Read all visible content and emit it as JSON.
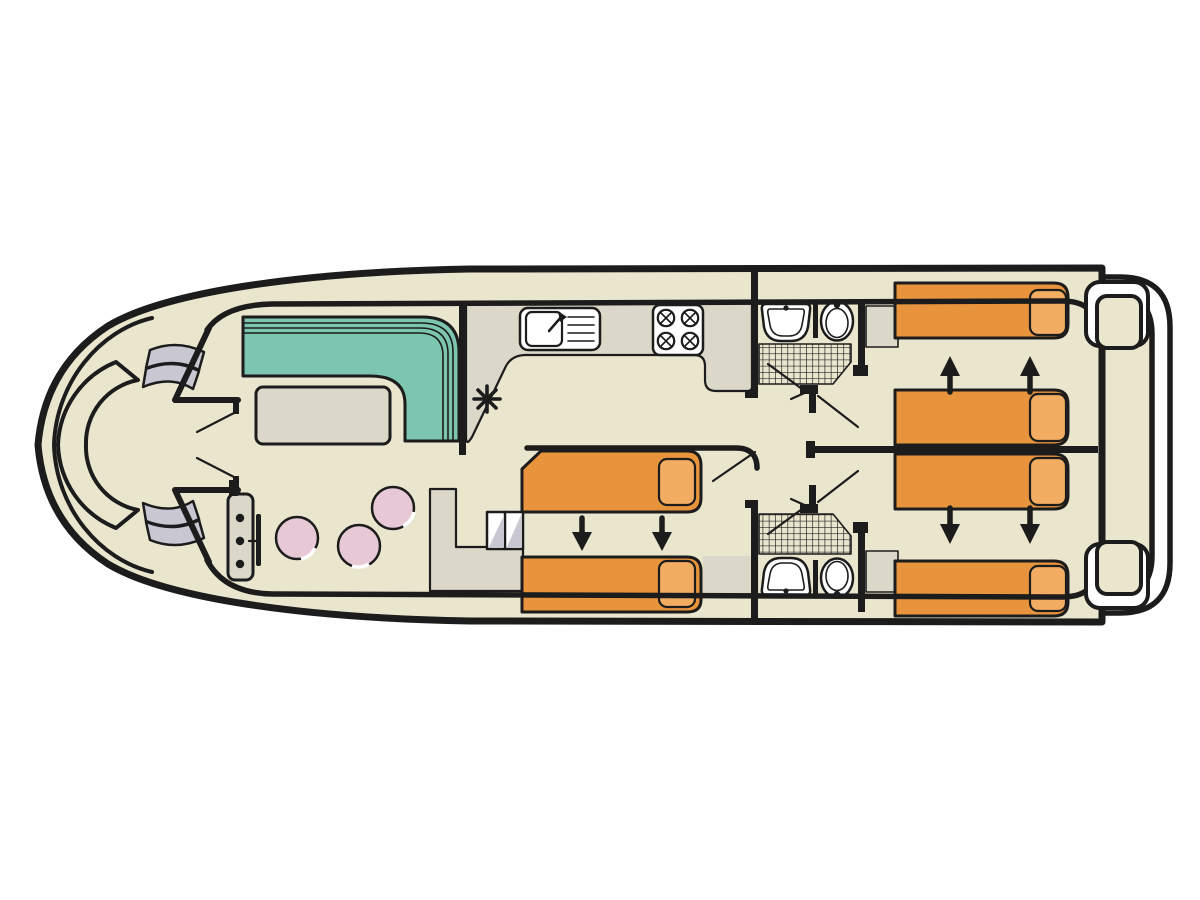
{
  "diagram": {
    "type": "boat-floor-plan",
    "orientation": "bow-left-stern-right"
  },
  "colors": {
    "background": "#ffffff",
    "outline": "#1c1c1c",
    "hull_cream": "#eae6ce",
    "floor_gray": "#dbd8c9",
    "steps_gray": "#c9c8d2",
    "sofa_teal": "#7cc5ae",
    "bed_orange": "#e8943c",
    "pillow_orange": "#f2ad62",
    "stool_pink": "#e7c9d6",
    "fixture_white": "#ffffff"
  },
  "features": {
    "bow_bench_seats": 1,
    "bow_side_step_flights": 2,
    "helm_console_instruments": 3,
    "helm_stools": 3,
    "saloon_sofa_shape": "L",
    "saloon_tables": 1,
    "galley_sink": 1,
    "galley_drainer_lines": 4,
    "galley_hob_burners": 4,
    "cabins": [
      {
        "position": "midship",
        "single_beds": 2,
        "slide_arrows": 2
      },
      {
        "position": "aft-top",
        "single_beds": 2,
        "slide_arrows": 2
      },
      {
        "position": "aft-bottom",
        "single_beds": 2,
        "slide_arrows": 2
      }
    ],
    "bathrooms": [
      {
        "position": "top",
        "basin": 1,
        "toilet": 1,
        "shower": 1
      },
      {
        "position": "bottom",
        "basin": 1,
        "toilet": 1,
        "shower": 1
      }
    ],
    "midship_step_treads": 2,
    "stern_step_pads": 2,
    "swim_platform": 1
  }
}
